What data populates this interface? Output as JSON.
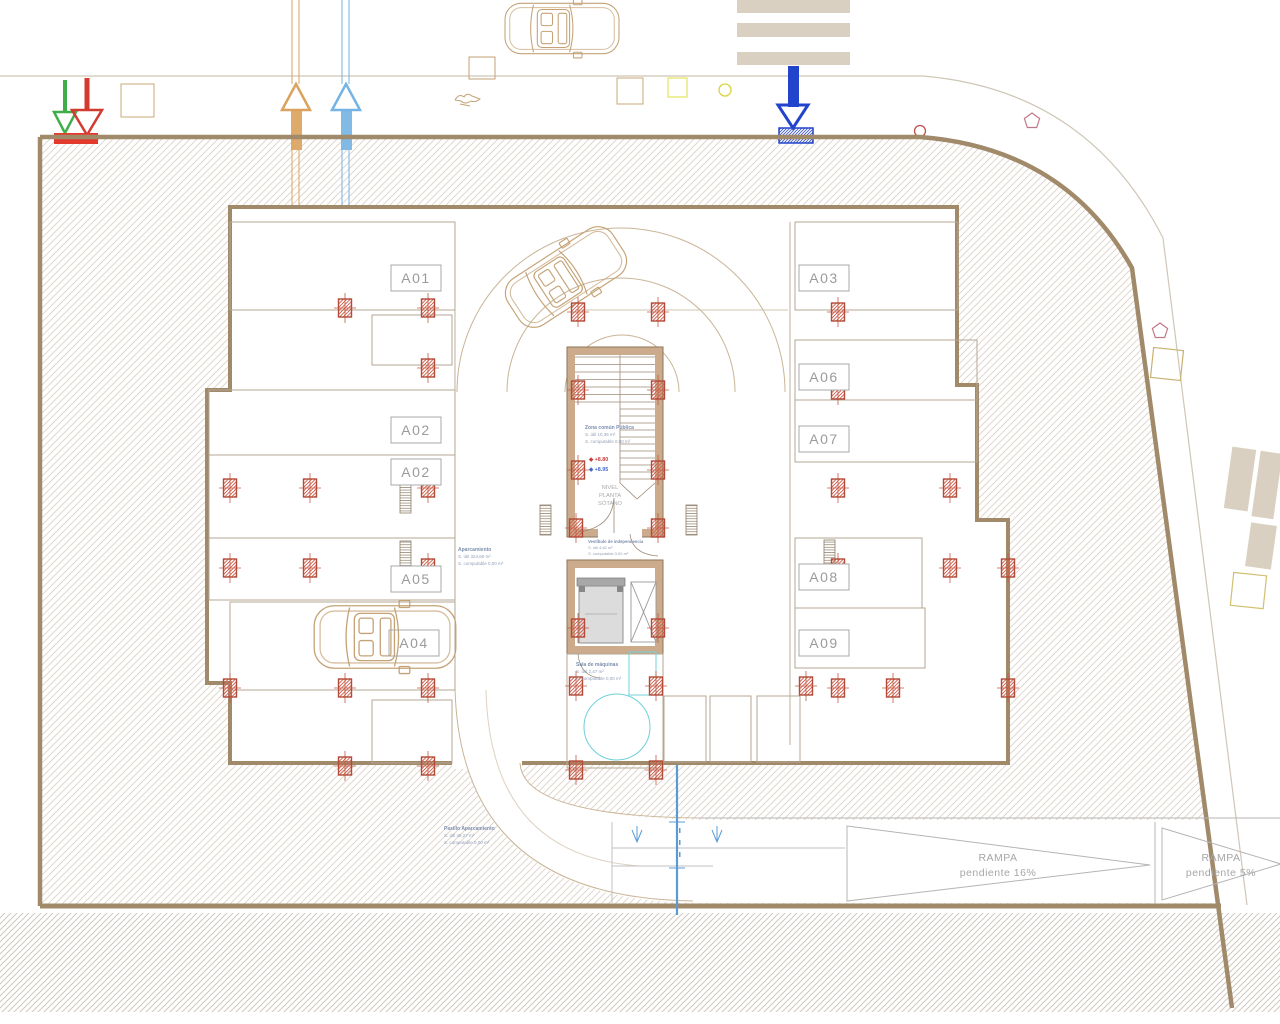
{
  "colors": {
    "wall": "#a08a6a",
    "core_wall_fill": "#cbab8b",
    "column_red": "#c05a45",
    "cyan": "#6fd0d8",
    "section_blue": "#5b9bd5",
    "entry_green": "#3fae49",
    "entry_red": "#d43b2f",
    "entry_orange": "#dba25d",
    "entry_lightblue": "#74b3e3",
    "entry_darkblue": "#2244cc"
  },
  "parking": {
    "spaces": [
      {
        "label": "A01"
      },
      {
        "label": "A02"
      },
      {
        "label": "A02"
      },
      {
        "label": "A05"
      },
      {
        "label": "A04"
      },
      {
        "label": "A03"
      },
      {
        "label": "A06"
      },
      {
        "label": "A07"
      },
      {
        "label": "A08"
      },
      {
        "label": "A09"
      }
    ]
  },
  "rooms": {
    "zona_comun": {
      "name": "Zona común Pública",
      "area": "S. útil 10,35 m²",
      "computable": "S. computable 0,00 m²"
    },
    "aparcamiento": {
      "name": "Aparcamiento",
      "area": "S. útil 324,60 m²",
      "computable": "S. computable 0,00 m²"
    },
    "vestibulo": {
      "name": "Vestíbulo de independencia",
      "area": "S. útil 4,62 m²",
      "computable": "S. computable 0,00 m²"
    },
    "sala_maquinas": {
      "name": "Sala de máquinas",
      "area": "S. útil 2,47 m²",
      "computable": "S. computable 0,00 m²"
    },
    "pasillo": {
      "name": "Pasillo Aparcamiento",
      "area": "S. útil 48,27 m²",
      "computable": "S. computable 0,00 m²"
    }
  },
  "level_marker": {
    "line1": "NIVEL",
    "line2": "PLANTA",
    "line3": "SÓTANO"
  },
  "elevations": {
    "upper": "◆ +8.80",
    "lower": "◆ +8.95"
  },
  "ramps": [
    {
      "name": "RAMPA",
      "slope": "pendiente 16%"
    },
    {
      "name": "RAMPA",
      "slope": "pendiente 5%"
    }
  ]
}
